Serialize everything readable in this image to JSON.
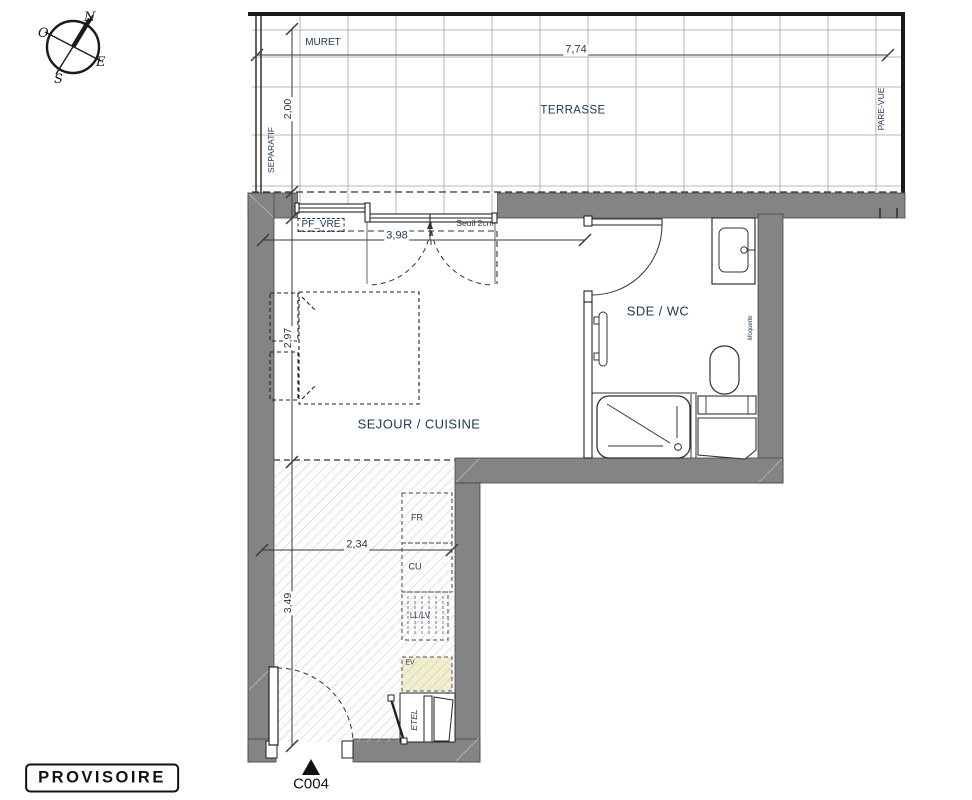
{
  "compass": {
    "n": "N",
    "o": "O",
    "e": "E",
    "s": "S"
  },
  "terrace": {
    "name": "TERRASSE",
    "muret": "MURET",
    "separatif": "SEPARATIF",
    "pare_vue": "PARE-VUE",
    "width": "7,74",
    "depth": "2,00"
  },
  "living": {
    "name": "SEJOUR / CUISINE",
    "window_label": "PF_VRE",
    "threshold": "Seuil 2cm",
    "width": "3,98",
    "depth": "2,97"
  },
  "kitchen": {
    "width": "2,34",
    "depth": "3,49",
    "fridge": "FR",
    "cooktop": "CU",
    "washer": "LL/LV",
    "sink": "EV",
    "closet": "ETEL"
  },
  "bathroom": {
    "name": "SDE / WC",
    "finish_note": "Moquette"
  },
  "footer": {
    "stamp": "PROVISOIRE",
    "unit": "C004"
  },
  "colors": {
    "wall": "#848484",
    "label": "#203a57",
    "hatch": "#c4c4c4",
    "sink_fill": "#f2edcc"
  }
}
